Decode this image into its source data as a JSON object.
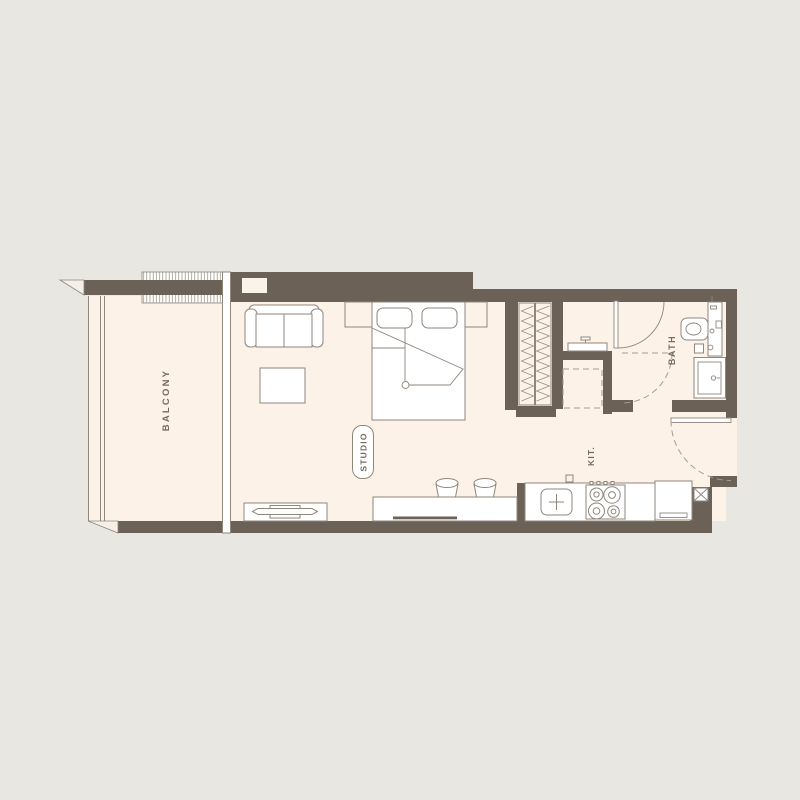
{
  "title": "Studio apartment floor plan",
  "labels": {
    "balcony": "BALCONY",
    "studio": "STUDIO",
    "kitchen": "KIT.",
    "bath": "BATH"
  },
  "colors": {
    "background": "#e9e7e2",
    "floor": "#fcf2e8",
    "wall": "#6b6157",
    "outline": "#8f867c",
    "text": "#756b60",
    "furniture_fill": "#ffffff"
  },
  "rooms": [
    "Balcony",
    "Studio",
    "Kitchen",
    "Bath"
  ]
}
